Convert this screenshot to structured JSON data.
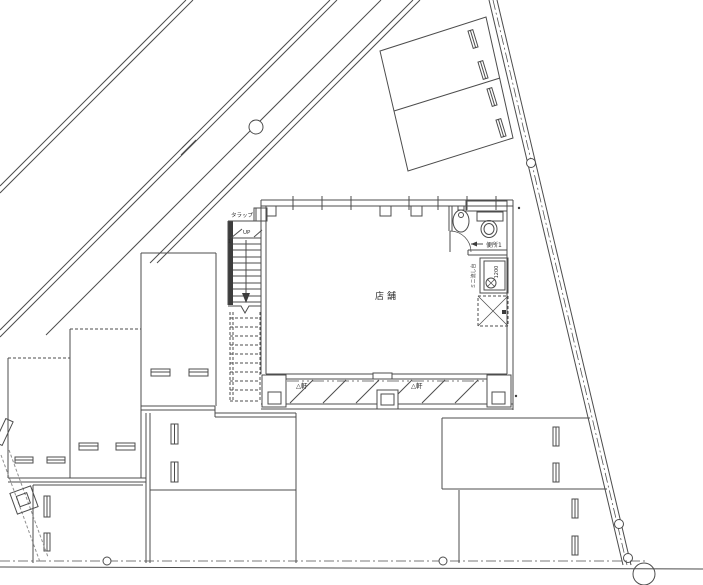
{
  "drawing": {
    "type": "architectural site and first-floor plan with shop, stair, toilet and parking stalls",
    "labels": {
      "ladder": "タラップ",
      "stair_up": "UP",
      "stair_number": "1",
      "shop_room": "店舗",
      "toilet_room": "便所1",
      "kitchen_unit": "ミニ流し台",
      "kitchen_width": "1200",
      "eave_mark_left": "△軒",
      "eave_mark_right": "△軒"
    },
    "colors": {
      "line": "#4c4c4c",
      "line_light": "#909090",
      "text": "#2e2e2e",
      "wall_fill": "#3c3c3c",
      "background": "#ffffff"
    }
  }
}
